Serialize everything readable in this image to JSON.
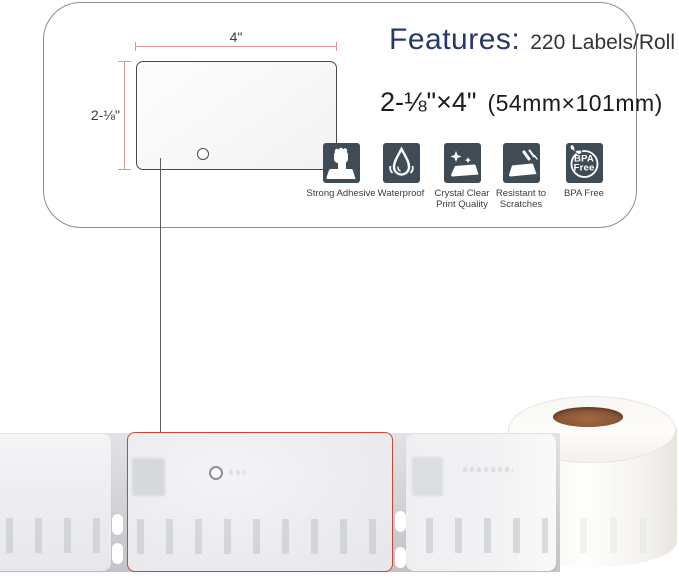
{
  "product_card": {
    "features_title": "Features:",
    "features_value": "220 Labels/Roll",
    "size_imperial": "2-⅛\"×4\"",
    "size_metric": "(54mm×101mm)",
    "dimension_width_label": "4\"",
    "dimension_height_label": "2-⅛\""
  },
  "feature_badges": [
    {
      "name": "strong-adhesive",
      "label": "Strong Adhesive",
      "icon": "fist-on-label-icon"
    },
    {
      "name": "waterproof",
      "label": "Waterproof",
      "icon": "water-droplet-icon"
    },
    {
      "name": "crystal-clear",
      "label": "Crystal Clear Print Quality",
      "icon": "sparkling-label-icon"
    },
    {
      "name": "scratch-resistant",
      "label": "Resistant to Scratches",
      "icon": "scratched-label-icon"
    },
    {
      "name": "bpa-free",
      "label": "BPA Free",
      "icon": "bpa-free-stamp-icon",
      "stamp_line1": "BPA",
      "stamp_line2": "Free"
    }
  ],
  "colors": {
    "badge_tile": "#3f4c55",
    "features_title_blue": "#27386b",
    "dimension_line_red": "#d9988f",
    "highlight_outline_red": "#c4493f",
    "roll_core_brown": "#8a5838"
  }
}
